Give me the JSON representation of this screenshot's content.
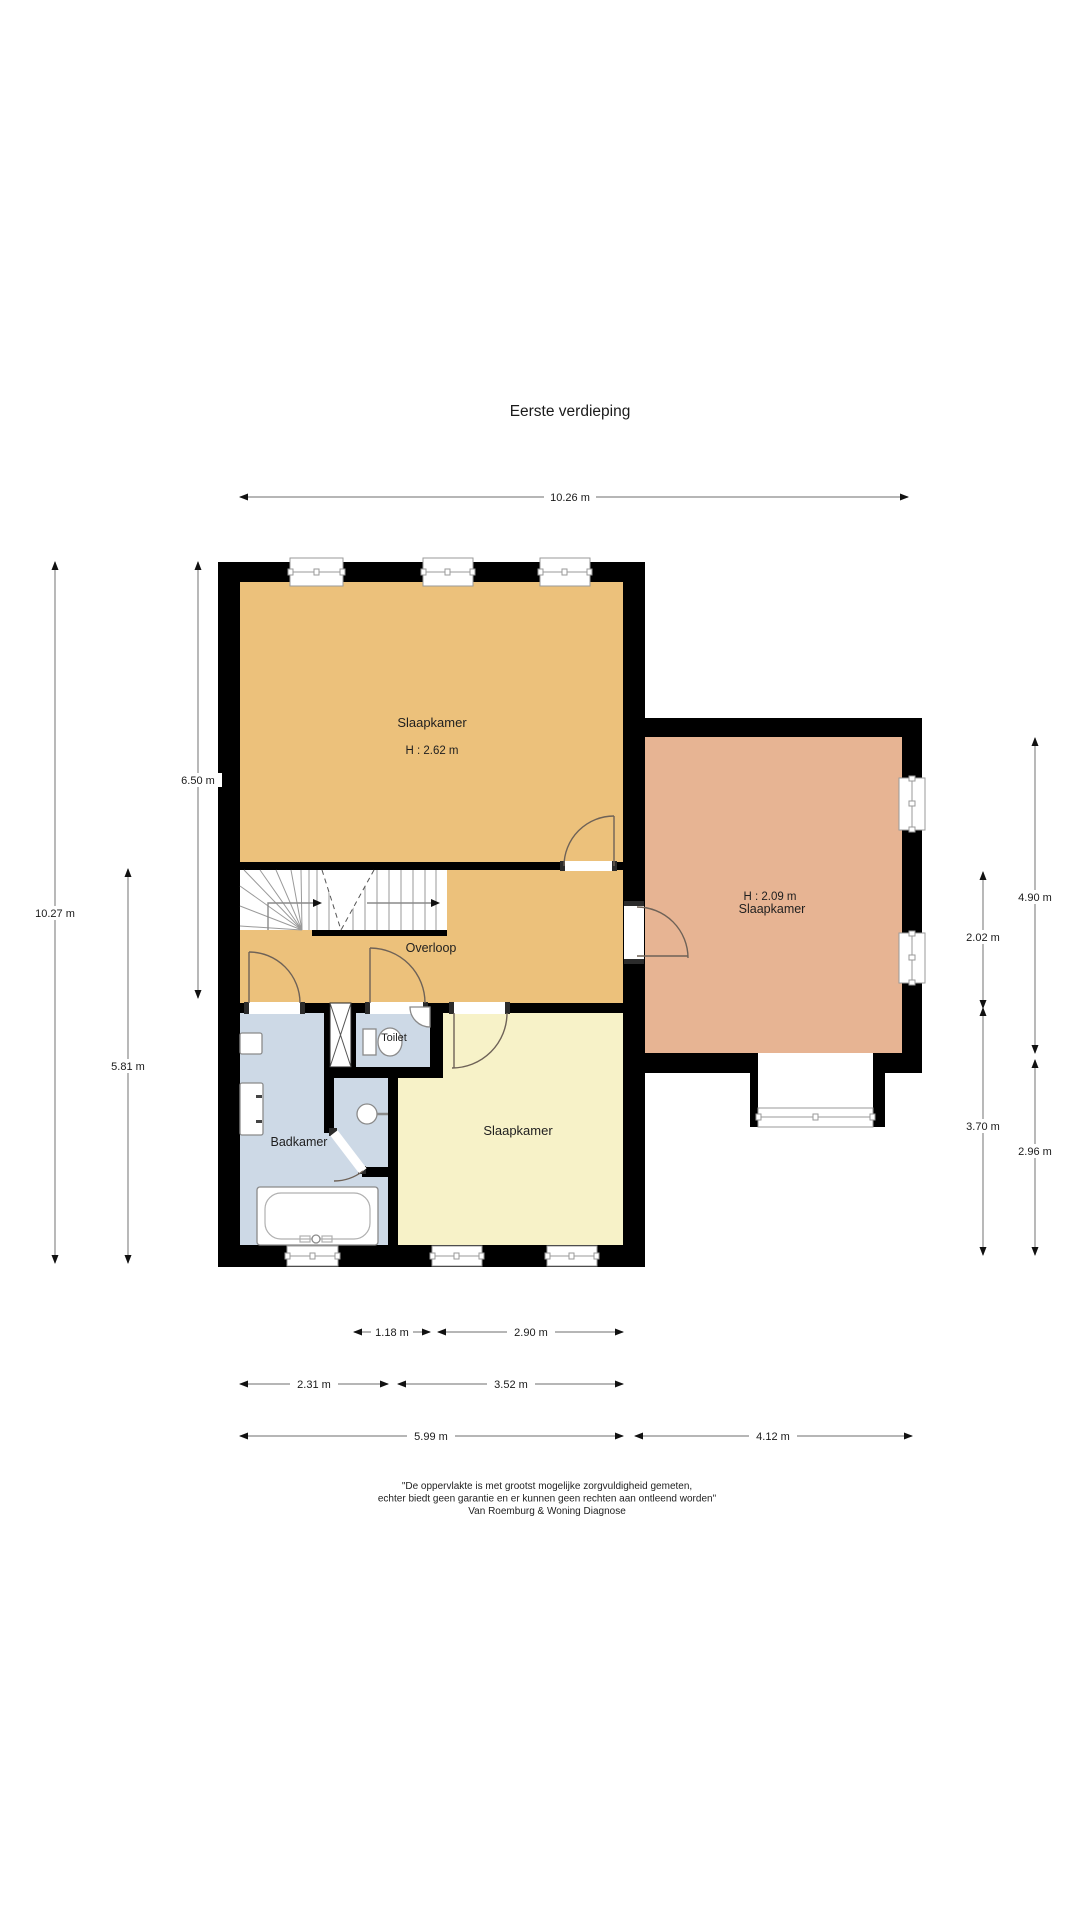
{
  "title": "Eerste verdieping",
  "rooms": {
    "bedroom_main": {
      "name": "Slaapkamer",
      "height": "H : 2.62 m"
    },
    "bedroom_right": {
      "height": "H : 2.09 m",
      "name": "Slaapkamer"
    },
    "landing": {
      "name": "Overloop"
    },
    "toilet": {
      "name": "Toilet"
    },
    "bathroom": {
      "name": "Badkamer"
    },
    "bedroom_bottom": {
      "name": "Slaapkamer"
    }
  },
  "dimensions": {
    "top": {
      "label": "10.26 m"
    },
    "left": [
      {
        "label": "10.27 m"
      },
      {
        "label": "5.81 m"
      },
      {
        "label": "6.50 m"
      }
    ],
    "right": [
      {
        "label": "4.90 m"
      },
      {
        "label": "2.02 m"
      },
      {
        "label": "3.70 m"
      },
      {
        "label": "2.96 m"
      }
    ],
    "bottom": [
      {
        "label": "1.18 m"
      },
      {
        "label": "2.90 m"
      },
      {
        "label": "2.31 m"
      },
      {
        "label": "3.52 m"
      },
      {
        "label": "5.99 m"
      },
      {
        "label": "4.12 m"
      }
    ]
  },
  "disclaimer": {
    "line1": "\"De oppervlakte is met grootst mogelijke zorgvuldigheid gemeten,",
    "line2": "echter biedt geen garantie en er kunnen geen rechten aan ontleend worden\"",
    "line3": "Van Roemburg & Woning Diagnose"
  },
  "colors": {
    "wall": "#000000",
    "bedroom_main": "#ecc17b",
    "landing": "#ecc17b",
    "bedroom_right": "#e7b493",
    "bedroom_bottom": "#f7f2c8",
    "bathroom": "#cdd9e6",
    "toilet_room": "#cdd9e6"
  }
}
